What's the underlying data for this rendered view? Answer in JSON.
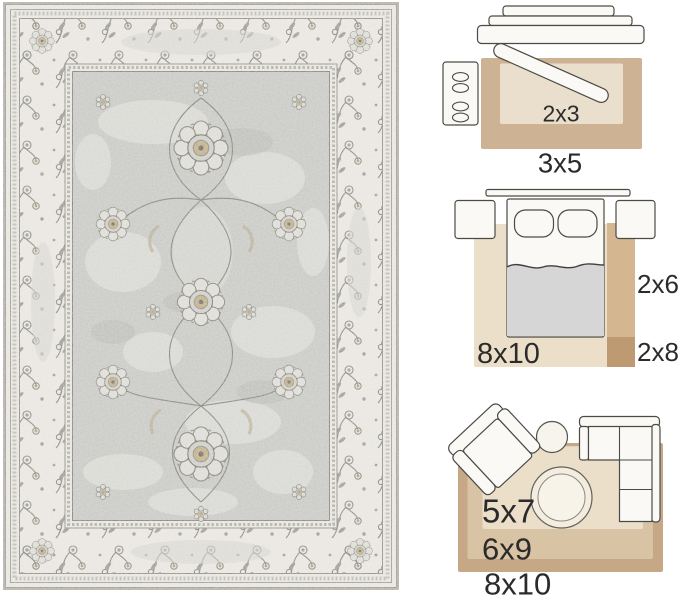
{
  "image": {
    "background": "#ffffff"
  },
  "rug_photo": {
    "palette": {
      "edge": "#b3afa5",
      "border_ivory": "#e9e6e0",
      "motif_gray": "#85857e",
      "field_gray": "#c7c7c4",
      "accent_gold": "#c1ae86",
      "distress_light": "#e3e2dd"
    }
  },
  "size_guide": {
    "label_color": "#2b2b2b",
    "entryway": {
      "inner_label": "2x3",
      "outer_label": "3x5",
      "outer_color": "#cdb294",
      "inner_color": "#eadfcd"
    },
    "bedroom": {
      "rug_label": "8x10",
      "runner_label": "2x6",
      "runner_end_label": "2x8",
      "rug_color": "#ecdfc9",
      "runner_color": "#d4b791",
      "runner_end_color": "#bd9a72",
      "blanket_color": "#d6d6d6"
    },
    "living_room": {
      "small_label": "5x7",
      "medium_label": "6x9",
      "large_label": "8x10",
      "outer_color": "#c6a886",
      "middle_color": "#d8c3a5",
      "inner_color": "#ebdfca"
    }
  }
}
